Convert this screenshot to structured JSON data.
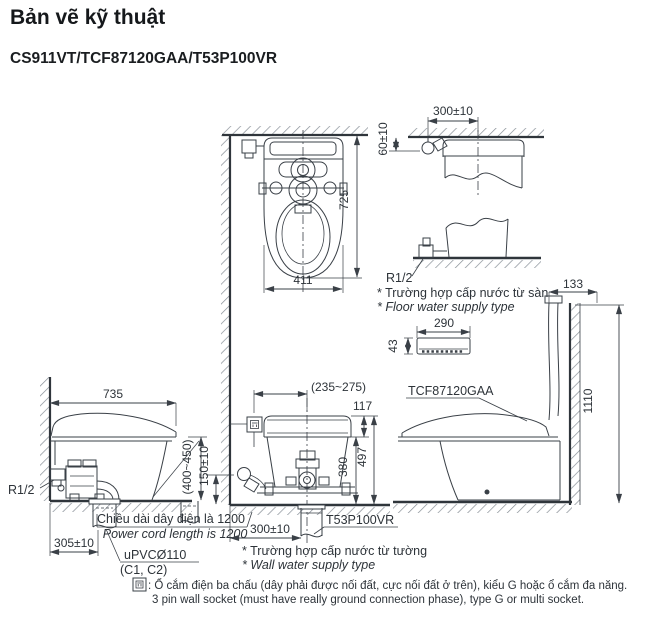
{
  "header": {
    "title": "Bản vẽ kỹ thuật",
    "product_code": "CS911VT/TCF87120GAA/T53P100VR"
  },
  "views": {
    "plan": {
      "depth": "725",
      "width": "411"
    },
    "floor_supply": {
      "offset": "300±10",
      "drop": "60±10",
      "thread": "R1/2",
      "caption_vi": "* Trường hợp cấp nước từ sàn",
      "caption_en": "* Floor water supply type"
    },
    "side_right": {
      "top_offset": "133",
      "total_height": "1110",
      "lid_label": "TCF87120GAA"
    },
    "remote": {
      "width": "290",
      "thickness": "43"
    },
    "side_left": {
      "depth": "735",
      "thread": "R1/2",
      "inlet_height": "(400~450)",
      "drain_offset": "305±10",
      "drain_pipe": "uPVCØ110",
      "drain_pipe_sub": "(C1, C2)",
      "cord_vi": "Chiều dài dây điện là 1200",
      "cord_en": "Power cord length is 1200"
    },
    "rear": {
      "socket_offset": "(235~275)",
      "top_to_rim": "117",
      "rim_height": "380",
      "tank_height": "497",
      "inlet_height": "150±10",
      "drain_offset": "300±10",
      "fitting_label": "T53P100VR",
      "caption_vi": "* Trường hợp cấp nước từ tường",
      "caption_en": "* Wall water supply type"
    }
  },
  "footnote": {
    "vi": ": Ổ cắm điện ba chấu (dây phải được nối đất, cực nối đất ở trên), kiểu G hoặc ổ cắm đa năng.",
    "en": "3 pin wall socket (must have really ground connection phase), type G or multi socket."
  }
}
